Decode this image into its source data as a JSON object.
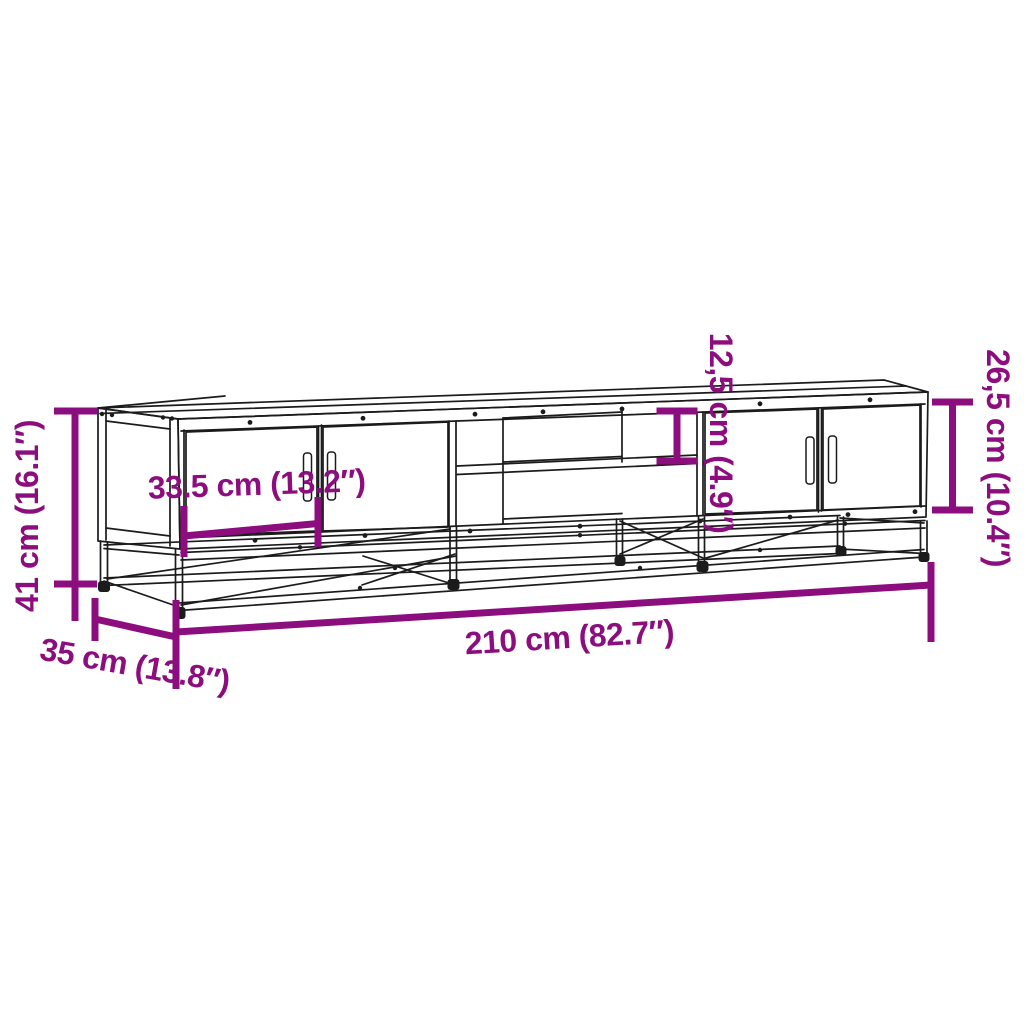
{
  "diagram": {
    "type": "furniture-dimension-drawing",
    "subject": "TV stand with metal frame, two double-door cabinets and open middle shelf compartment",
    "colors": {
      "dimension_annotation": "#8C0E7E",
      "line_art": "#1b1b1b",
      "background": "#ffffff"
    },
    "dimensions": {
      "overall_height": {
        "label": "41 cm (16.1″)"
      },
      "overall_depth": {
        "label": "35 cm (13.8″)"
      },
      "overall_width": {
        "label": "210 cm (82.7″)"
      },
      "door_width": {
        "label": "33.5 cm (13.2″)"
      },
      "shelf_opening_height": {
        "label": "12,5 cm (4.9″)"
      },
      "cabinet_body_height": {
        "label": "26,5 cm (10.4″)"
      }
    }
  }
}
